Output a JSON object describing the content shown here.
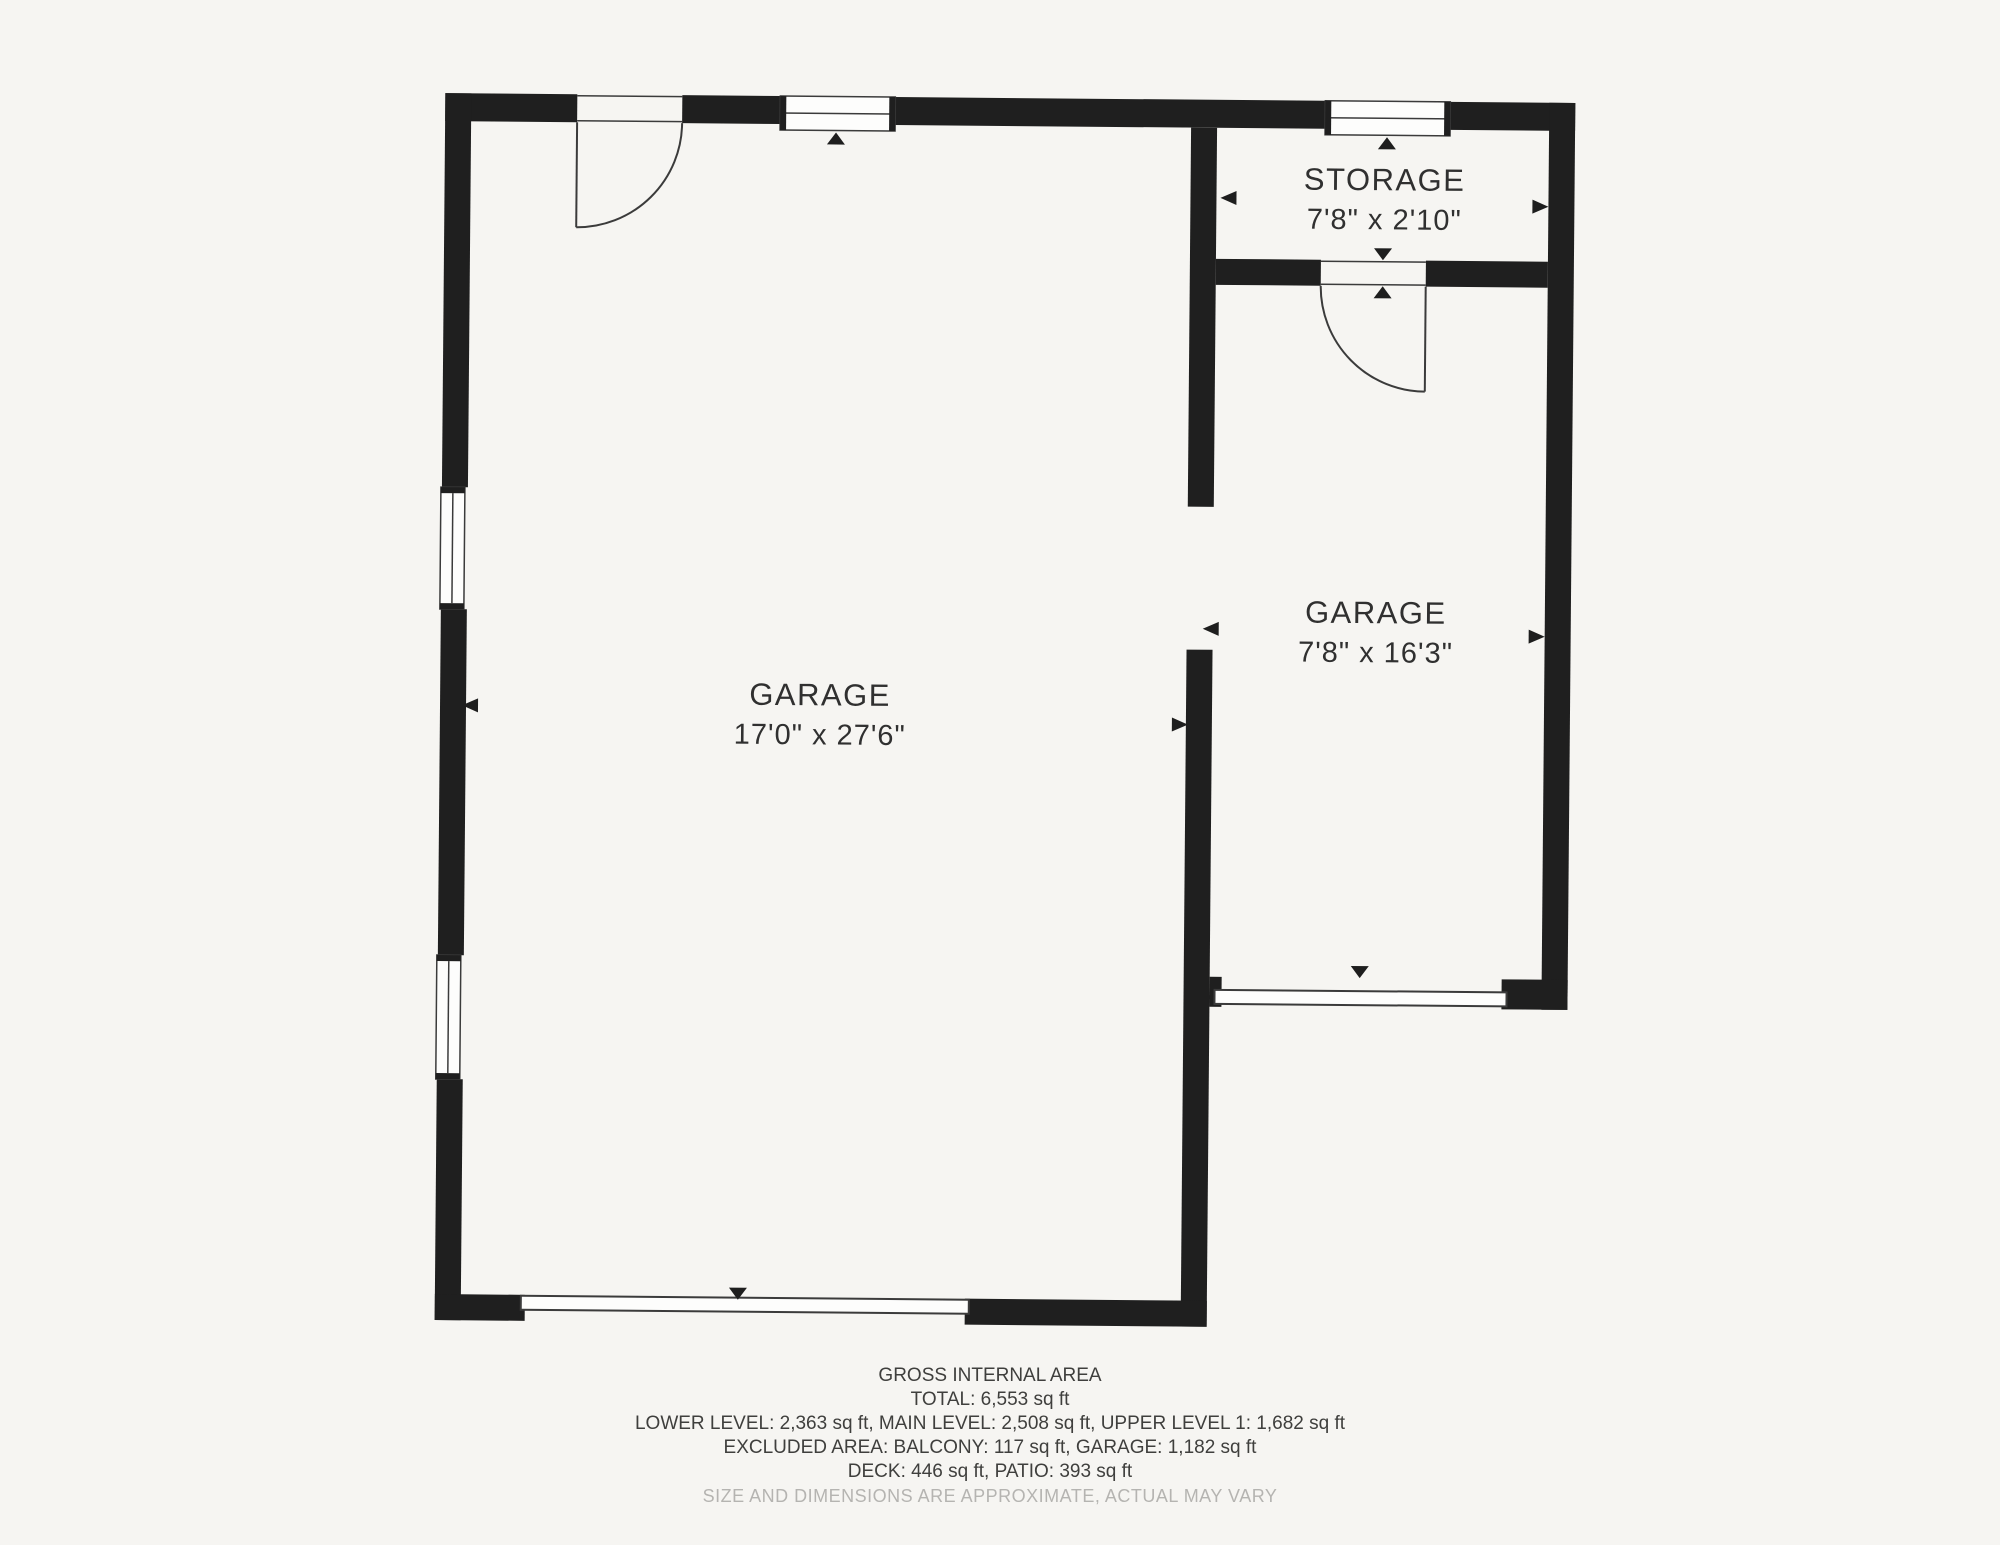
{
  "rooms": {
    "garage_main": {
      "name": "GARAGE",
      "dimensions": "17'0\" x 27'6\""
    },
    "garage_right": {
      "name": "GARAGE",
      "dimensions": "7'8\" x 16'3\""
    },
    "storage": {
      "name": "STORAGE",
      "dimensions": "7'8\" x 2'10\""
    }
  },
  "footer": {
    "title": "GROSS INTERNAL AREA",
    "total": "TOTAL: 6,553 sq ft",
    "levels": "LOWER LEVEL: 2,363 sq ft, MAIN LEVEL: 2,508 sq ft, UPPER LEVEL 1: 1,682 sq ft",
    "excluded": "EXCLUDED AREA: BALCONY: 117 sq ft, GARAGE: 1,182 sq ft",
    "deck_patio": "DECK: 446 sq ft, PATIO: 393 sq ft",
    "disclaimer": "SIZE AND DIMENSIONS ARE APPROXIMATE, ACTUAL MAY VARY"
  },
  "colors": {
    "wall": "#1f1f1f",
    "paper": "#f6f5f2",
    "line": "#3b3b3b",
    "label_text": "#303030",
    "disclaimer_text": "#b5b4b1"
  }
}
